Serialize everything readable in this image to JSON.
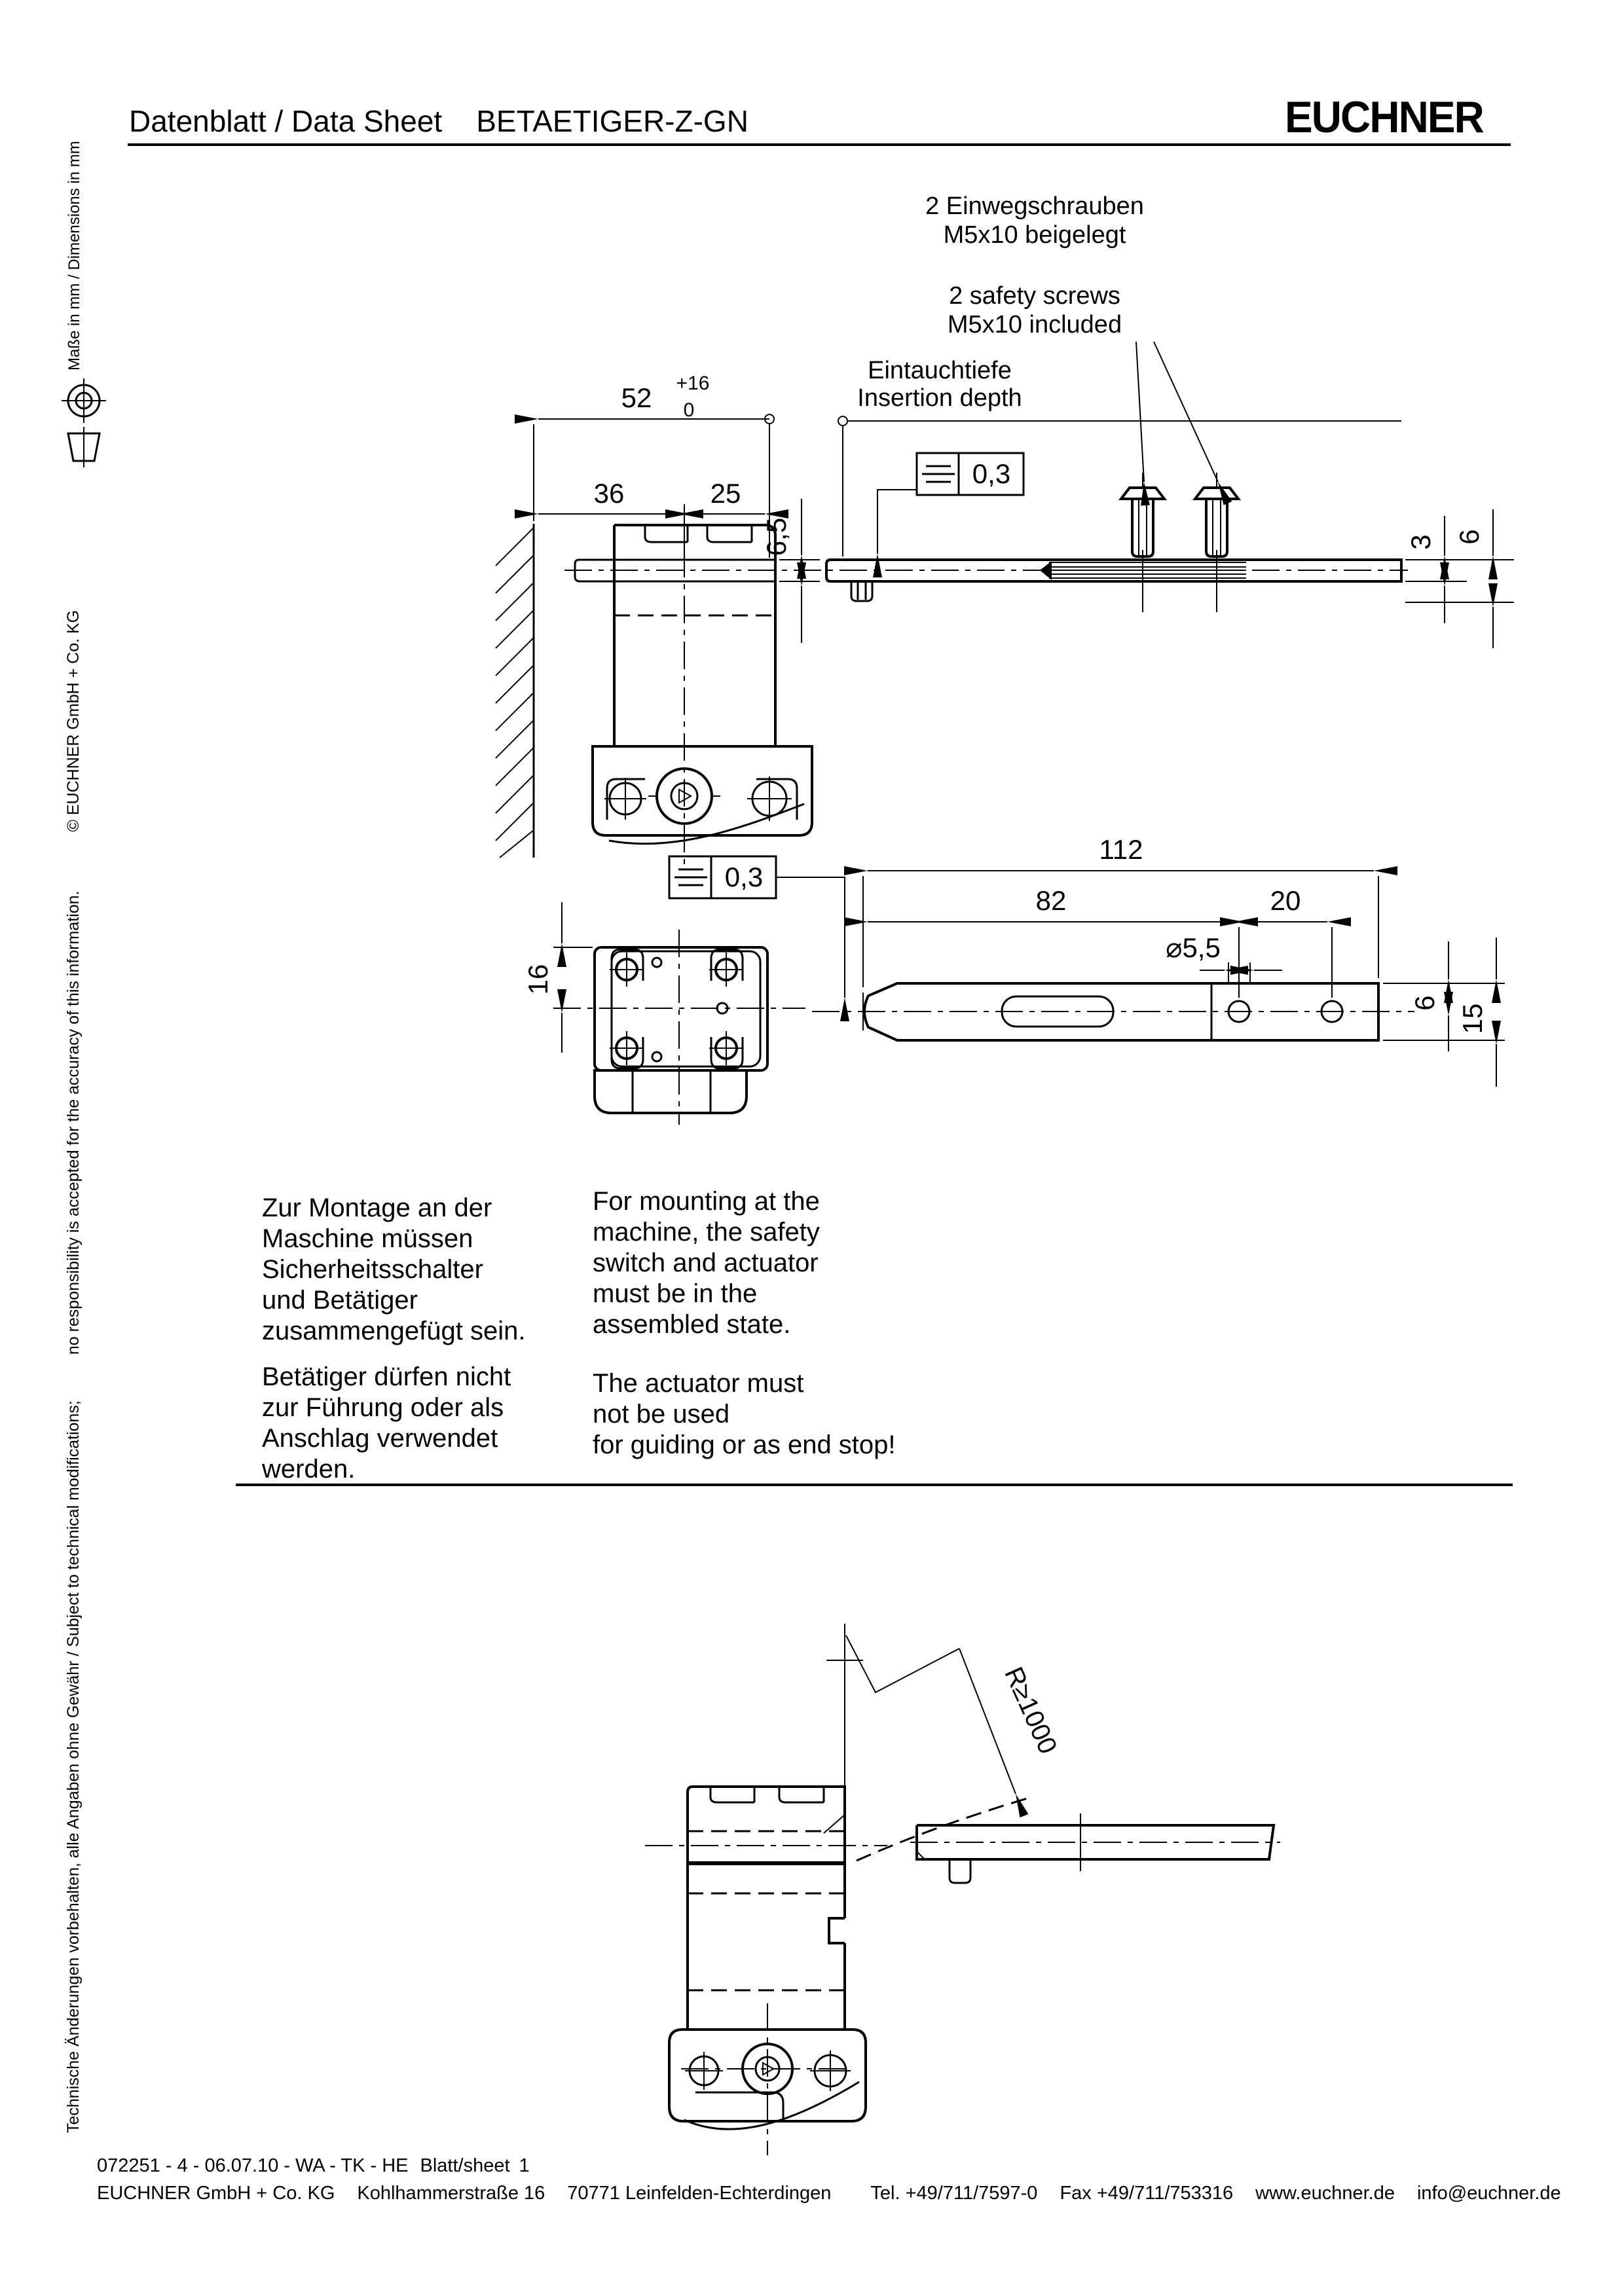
{
  "header": {
    "title": "Datenblatt / Data Sheet",
    "product": "BETAETIGER-Z-GN",
    "brand": "EUCHNER"
  },
  "sidebar": {
    "disclaimer_de": "Technische Änderungen vorbehalten, alle Angaben ohne Gewähr / Subject to technical modifications;",
    "disclaimer_en": "no responsibility is accepted for the accuracy of this information.",
    "copyright": "© EUCHNER GmbH + Co. KG",
    "units": "Maße in mm / Dimensions in mm",
    "projection_symbol": "first-angle-projection-icon"
  },
  "notes": {
    "screws_de": "2 Einwegschrauben\nM5x10 beigelegt",
    "screws_en": "2 safety screws\nM5x10 included",
    "insertion_de": "Eintauchtiefe",
    "insertion_en": "Insertion depth"
  },
  "dims_side_view": {
    "overall": "52",
    "tol_plus": "+16",
    "tol_zero": "0",
    "left": "36",
    "right": "25",
    "offset": "6,5",
    "plate": "3",
    "height": "6",
    "symmetry": "0,3"
  },
  "dims_top_view": {
    "length": "112",
    "hole_distance": "82",
    "hole_pitch": "20",
    "hole_dia": "⌀5,5",
    "head": "16",
    "center": "6",
    "width": "15",
    "symmetry": "0,3"
  },
  "dims_radius_view": {
    "radius": "R≥1000"
  },
  "paragraphs": {
    "mount_de": "Zur Montage an der\nMaschine müssen\nSicherheitsschalter\nund Betätiger\nzusammengefügt sein.",
    "mount_en": "For mounting at the\nmachine, the safety\nswitch and actuator\nmust be in the\nassembled state.",
    "actuator_de": "Betätiger dürfen nicht\nzur Führung oder als\nAnschlag verwendet\nwerden.",
    "actuator_en": "The actuator must\nnot be used\nfor guiding or as end stop!"
  },
  "footer": {
    "doc_line": "072251 - 4 - 06.07.10 - WA -  TK - HE",
    "sheet_label": "Blatt/sheet",
    "sheet_number": "1",
    "company": "EUCHNER GmbH + Co. KG",
    "street": "Kohlhammerstraße 16",
    "city": "70771 Leinfelden-Echterdingen",
    "phone": "Tel. +49/711/7597-0",
    "fax": "Fax +49/711/753316",
    "website": "www.euchner.de",
    "email": "info@euchner.de"
  }
}
